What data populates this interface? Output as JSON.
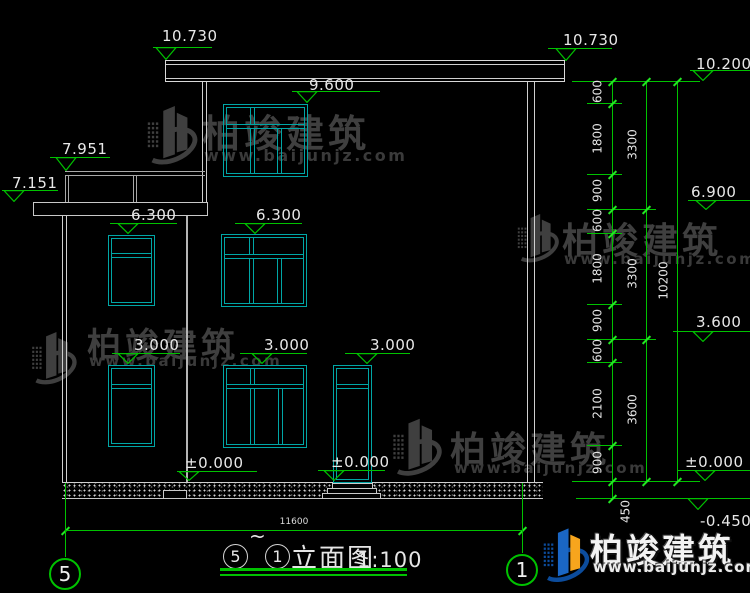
{
  "title": {
    "left_bubble": "5",
    "tilde": "~",
    "right_bubble": "1",
    "name": "立面图",
    "scale": "1:100"
  },
  "grid": {
    "left": "5",
    "right": "1"
  },
  "bottom_dimension": "11600",
  "watermark": {
    "brand": "柏竣建筑",
    "site": "www.baijunjz.com"
  },
  "elevation_markers": [
    "10.730",
    "10.730",
    "10.200",
    "9.600",
    "7.951",
    "7.151",
    "6.300",
    "6.300",
    "6.900",
    "3.600",
    "3.000",
    "3.000",
    "3.000",
    "±0.000",
    "±0.000",
    "±0.000",
    "-0.450"
  ],
  "dimension_chain": {
    "col1": [
      "600",
      "1800",
      "900",
      "600",
      "1800",
      "900",
      "600",
      "2100",
      "900",
      "450"
    ],
    "col2": [
      "3300",
      "3300",
      "3600"
    ],
    "col3": [
      "10200"
    ]
  }
}
